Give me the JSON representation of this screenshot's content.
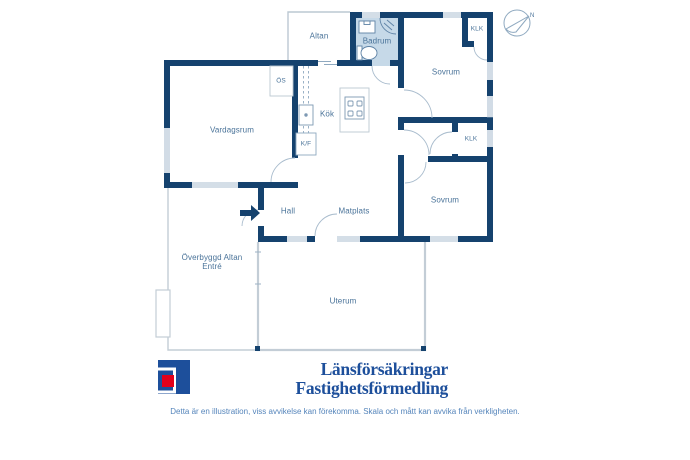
{
  "floorplan": {
    "rooms": {
      "altan": "Altan",
      "badrum": "Badrum",
      "klk_top": "KLK",
      "sovrum_top": "Sovrum",
      "os": "ÖS",
      "vardagsrum": "Vardagsrum",
      "kok": "Kök",
      "kf": "K/F",
      "klk_mid": "KLK",
      "sovrum_bottom": "Sovrum",
      "hall": "Hall",
      "matplats": "Matplats",
      "overbyggd_line1": "Överbyggd Altan",
      "overbyggd_line2": "Entré",
      "uterum": "Uterum"
    },
    "compass": {
      "north_label": "N"
    },
    "icons": [
      "compass-icon",
      "entrance-arrow-icon",
      "toilet-icon",
      "sink-icon",
      "shower-icon",
      "stove-icon",
      "kitchen-sink-icon",
      "fridge-freezer-box",
      "fireplace-box"
    ]
  },
  "branding": {
    "line1": "Länsförsäkringar",
    "line2": "Fastighetsförmedling"
  },
  "disclaimer": "Detta är en illustration, viss avvikelse kan förekomma. Skala och mått kan avvika från verkligheten.",
  "colors": {
    "wall": "#15426e",
    "bathroom_fill": "#c6d9e8",
    "label_text": "#4a7399",
    "brand_blue": "#1d4f9b",
    "brand_red": "#e2001a"
  }
}
